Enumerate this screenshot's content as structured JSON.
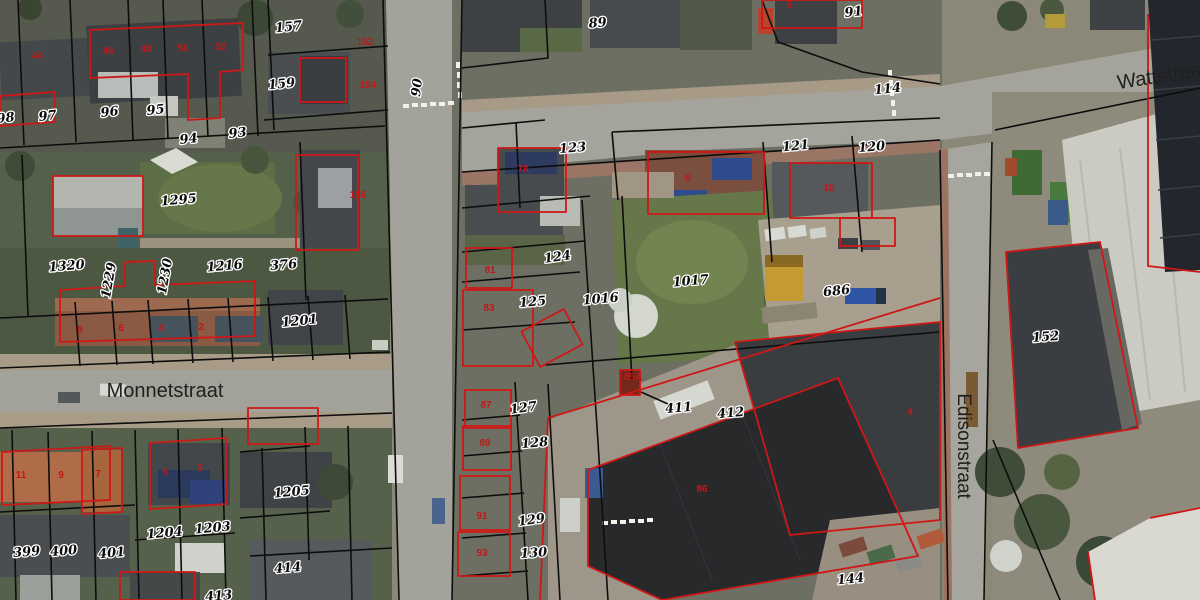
{
  "map": {
    "title": "cadastral-aerial-view",
    "colors": {
      "parcel_boundary": "#0d0d0d",
      "building_outline": "#cf1716",
      "parcel_label_fill": "#0b0b0b",
      "parcel_label_halo": "#ffffff",
      "building_label": "#c0181a",
      "street_label": "#20201e",
      "road": "#a3a39b"
    },
    "streets": [
      {
        "name": "Monnetstraat",
        "x": 165,
        "y": 397,
        "rot": 0,
        "size": 20
      },
      {
        "name": "Wattstraat",
        "x": 1163,
        "y": 82,
        "rot": -9,
        "size": 20
      },
      {
        "name": "Edisonstraat",
        "x": 958,
        "y": 446,
        "rot": 90,
        "size": 19
      }
    ],
    "parcel_labels": [
      {
        "text": "98",
        "x": 6,
        "y": 122,
        "rot": -6
      },
      {
        "text": "97",
        "x": 48,
        "y": 120,
        "rot": -6
      },
      {
        "text": "96",
        "x": 110,
        "y": 116,
        "rot": -6
      },
      {
        "text": "95",
        "x": 156,
        "y": 114,
        "rot": -6
      },
      {
        "text": "94",
        "x": 189,
        "y": 143,
        "rot": -6
      },
      {
        "text": "93",
        "x": 238,
        "y": 137,
        "rot": -6
      },
      {
        "text": "157",
        "x": 289,
        "y": 31,
        "rot": -6
      },
      {
        "text": "159",
        "x": 282,
        "y": 88,
        "rot": -6
      },
      {
        "text": "1295",
        "x": 179,
        "y": 204,
        "rot": -5
      },
      {
        "text": "1320",
        "x": 67,
        "y": 270,
        "rot": -5
      },
      {
        "text": "1229",
        "x": 113,
        "y": 281,
        "rot": -80
      },
      {
        "text": "1230",
        "x": 169,
        "y": 277,
        "rot": -80
      },
      {
        "text": "1216",
        "x": 225,
        "y": 270,
        "rot": -5
      },
      {
        "text": "376",
        "x": 284,
        "y": 269,
        "rot": -5
      },
      {
        "text": "1201",
        "x": 300,
        "y": 325,
        "rot": -6
      },
      {
        "text": "399",
        "x": 27,
        "y": 556,
        "rot": -5
      },
      {
        "text": "400",
        "x": 64,
        "y": 555,
        "rot": -5
      },
      {
        "text": "401",
        "x": 112,
        "y": 557,
        "rot": -5
      },
      {
        "text": "1204",
        "x": 165,
        "y": 537,
        "rot": -5
      },
      {
        "text": "1203",
        "x": 213,
        "y": 532,
        "rot": -5
      },
      {
        "text": "1205",
        "x": 292,
        "y": 496,
        "rot": -5
      },
      {
        "text": "414",
        "x": 288,
        "y": 572,
        "rot": -5
      },
      {
        "text": "413",
        "x": 219,
        "y": 600,
        "rot": -5
      },
      {
        "text": "90",
        "x": 421,
        "y": 88,
        "rot": -83
      },
      {
        "text": "89",
        "x": 598,
        "y": 27,
        "rot": -5
      },
      {
        "text": "123",
        "x": 573,
        "y": 152,
        "rot": -5
      },
      {
        "text": "124",
        "x": 558,
        "y": 261,
        "rot": -8
      },
      {
        "text": "125",
        "x": 533,
        "y": 306,
        "rot": -5
      },
      {
        "text": "1016",
        "x": 601,
        "y": 303,
        "rot": -5
      },
      {
        "text": "1017",
        "x": 691,
        "y": 285,
        "rot": -5
      },
      {
        "text": "127",
        "x": 524,
        "y": 412,
        "rot": -8
      },
      {
        "text": "128",
        "x": 535,
        "y": 447,
        "rot": -5
      },
      {
        "text": "129",
        "x": 532,
        "y": 524,
        "rot": -8
      },
      {
        "text": "130",
        "x": 534,
        "y": 557,
        "rot": -4
      },
      {
        "text": "411",
        "x": 679,
        "y": 412,
        "rot": -5
      },
      {
        "text": "412",
        "x": 731,
        "y": 417,
        "rot": -5
      },
      {
        "text": "91",
        "x": 854,
        "y": 16,
        "rot": -6
      },
      {
        "text": "114",
        "x": 888,
        "y": 93,
        "rot": -6
      },
      {
        "text": "121",
        "x": 796,
        "y": 150,
        "rot": -6
      },
      {
        "text": "120",
        "x": 872,
        "y": 151,
        "rot": -5
      },
      {
        "text": "686",
        "x": 837,
        "y": 295,
        "rot": -6
      },
      {
        "text": "152",
        "x": 1046,
        "y": 341,
        "rot": -5
      },
      {
        "text": "144",
        "x": 851,
        "y": 583,
        "rot": -6
      }
    ],
    "building_labels": [
      {
        "text": "44",
        "x": 37,
        "y": 59
      },
      {
        "text": "46",
        "x": 108,
        "y": 54
      },
      {
        "text": "48",
        "x": 146,
        "y": 52
      },
      {
        "text": "50",
        "x": 183,
        "y": 51
      },
      {
        "text": "52",
        "x": 221,
        "y": 50
      },
      {
        "text": "152",
        "x": 365,
        "y": 45
      },
      {
        "text": "154",
        "x": 368,
        "y": 88
      },
      {
        "text": "156",
        "x": 358,
        "y": 198
      },
      {
        "text": "8",
        "x": 80,
        "y": 333
      },
      {
        "text": "6",
        "x": 121,
        "y": 331
      },
      {
        "text": "4",
        "x": 161,
        "y": 331
      },
      {
        "text": "2",
        "x": 201,
        "y": 330
      },
      {
        "text": "11",
        "x": 21,
        "y": 478
      },
      {
        "text": "9",
        "x": 61,
        "y": 478
      },
      {
        "text": "7",
        "x": 98,
        "y": 477
      },
      {
        "text": "5",
        "x": 165,
        "y": 475
      },
      {
        "text": "3",
        "x": 200,
        "y": 471
      },
      {
        "text": "78",
        "x": 523,
        "y": 172
      },
      {
        "text": "81",
        "x": 490,
        "y": 273
      },
      {
        "text": "83",
        "x": 489,
        "y": 311
      },
      {
        "text": "87",
        "x": 486,
        "y": 408
      },
      {
        "text": "89",
        "x": 485,
        "y": 446
      },
      {
        "text": "91",
        "x": 482,
        "y": 519
      },
      {
        "text": "93",
        "x": 482,
        "y": 556
      },
      {
        "text": "85A",
        "x": 633,
        "y": 380
      },
      {
        "text": "86",
        "x": 702,
        "y": 492
      },
      {
        "text": "5",
        "x": 789,
        "y": 8
      },
      {
        "text": "10",
        "x": 829,
        "y": 191
      },
      {
        "text": "6",
        "x": 688,
        "y": 181
      },
      {
        "text": "4",
        "x": 910,
        "y": 415
      }
    ]
  }
}
